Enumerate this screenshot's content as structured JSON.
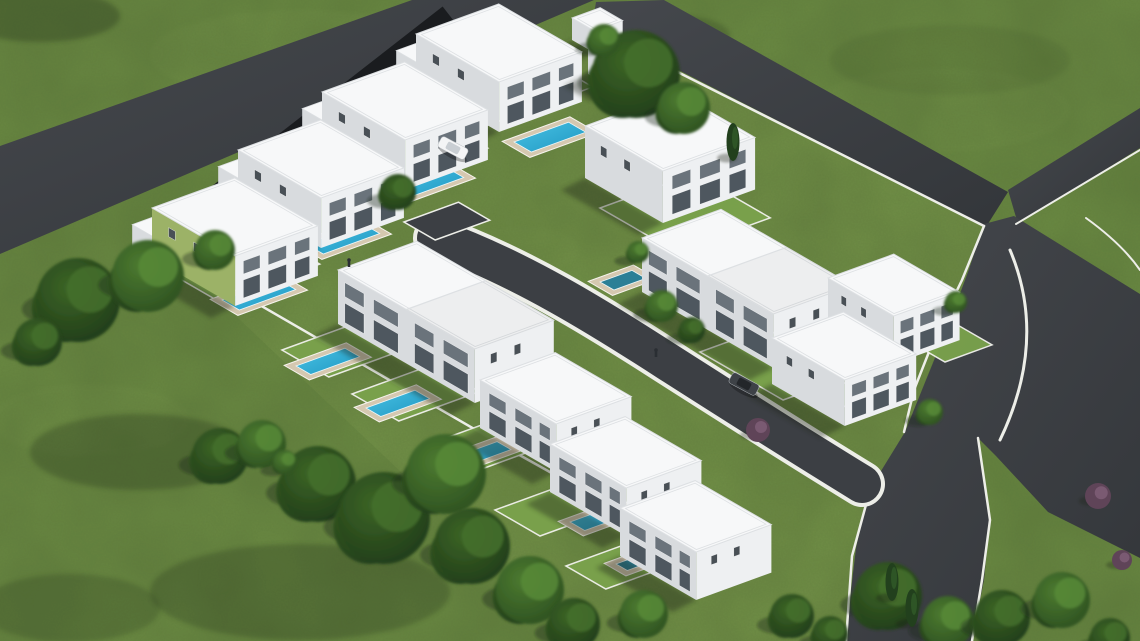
{
  "meta": {
    "description": "Aerial isometric 3D architectural rendering of a residential development: fourteen white flat-roof villas with private swimming pools and walled gardens on a green field, bounded by dark asphalt roads with an internal cul-de-sac street, scattered trees and shrubs",
    "canvas": {
      "width": 1140,
      "height": 641
    }
  },
  "palette": {
    "grass": "#6b8b43",
    "grass_tint": "#7b9a4e",
    "grass_light": "#8fae5f",
    "grass_dark": "#1e2c12",
    "road_a": "#45484d",
    "road_b": "#33363a",
    "road_internal": "#3c3f44",
    "lane": "#1a1c1f",
    "curb": "#edeee8",
    "garden": "#7aa24c",
    "garden_wall": "#f2f2ed",
    "roof": "#f7f8f9",
    "roof_edge": "#dde0e3",
    "wall_front": "#eef0f2",
    "wall_side": "#d8dbde",
    "accent_green": "#9cb267",
    "window_upper": "#6a737b",
    "window_lower": "#4e575f",
    "window_slit": "#495056",
    "pool_light": "#49c2e4",
    "pool_deep": "#1f97c2",
    "pool_teal": "#2b7f96",
    "deck": "#d5c8b0",
    "deck_edge": "#f6f4ee",
    "tree_dark_in": "#3c6526",
    "tree_dark_out": "#1f3a18",
    "tree_mid_in": "#4c7a30",
    "tree_mid_out": "#2c4f20",
    "shrub_purple": "#5f4458",
    "shadow": "#1c2414",
    "car_white_body": "#f4f5f6",
    "car_white_top": "#c9ced3",
    "car_dark_body": "#3e4247",
    "car_dark_top": "#23262a",
    "person": "#2a2e33",
    "cypress": "#22401d"
  },
  "roads": [
    {
      "name": "road-northwest",
      "points": "412,0 594,0 0,254 0,146"
    },
    {
      "name": "road-northeast",
      "points": "596,2 664,0 1008,192 986,227 592,26"
    },
    {
      "name": "road-north-branch",
      "points": "1008,190 1140,108 1140,148 1018,224"
    },
    {
      "name": "road-east-southeast",
      "points": "984,224 1014,216 1140,294 1140,558 1048,512 996,456 978,438 990,520 984,580 972,641 845,641 856,548 868,492 905,432 926,380 948,326 968,272"
    }
  ],
  "block_tint": "594,26 986,227 905,432 856,548 845,641 580,641 168,252",
  "rear_lane": {
    "path": "M450,16 L170,234",
    "width": 24
  },
  "internal_road": {
    "path": "M436,238 C520,268 600,318 668,362 C740,408 800,446 862,484",
    "curb_width": 46,
    "road_width": 38
  },
  "hammerhead": {
    "x": 404,
    "y": 222,
    "w": 58,
    "d": 36
  },
  "curbs": [
    {
      "name": "wall-northeast-boundary",
      "path": "M594,30 L984,226",
      "w": 2.5
    },
    {
      "name": "curb-east-inner",
      "path": "M984,226 L962,280 L936,334 L914,390 L904,432",
      "w": 2.5
    },
    {
      "name": "curb-southeast-left",
      "path": "M870,490 L852,556 L846,641",
      "w": 2.5
    },
    {
      "name": "curb-southeast-right",
      "path": "M978,438 L990,520 L982,580 L972,641",
      "w": 2.5
    },
    {
      "name": "curb-north-branch",
      "path": "M1016,224 L1140,150",
      "w": 2
    },
    {
      "name": "curb-east-corner-arc",
      "path": "M1010,250 Q1048,340 1000,440",
      "w": 3
    },
    {
      "name": "curb-northeast-corner-arc",
      "path": "M1086,218 Q1122,244 1140,270",
      "w": 2
    },
    {
      "name": "wall-southwest-boundary",
      "path": "M168,252 L514,452 L600,500",
      "w": 2.5
    }
  ],
  "gardens": [
    {
      "x": 168,
      "y": 272,
      "w": 108,
      "d": 58
    },
    {
      "x": 252,
      "y": 214,
      "w": 108,
      "d": 58
    },
    {
      "x": 336,
      "y": 156,
      "w": 108,
      "d": 58
    },
    {
      "x": 428,
      "y": 98,
      "w": 120,
      "d": 60
    },
    {
      "x": 600,
      "y": 208,
      "w": 100,
      "d": 88
    },
    {
      "x": 282,
      "y": 350,
      "w": 86,
      "d": 54
    },
    {
      "x": 352,
      "y": 394,
      "w": 86,
      "d": 54
    },
    {
      "x": 424,
      "y": 446,
      "w": 86,
      "d": 54
    },
    {
      "x": 495,
      "y": 510,
      "w": 86,
      "d": 52
    },
    {
      "x": 566,
      "y": 566,
      "w": 76,
      "d": 46
    },
    {
      "x": 700,
      "y": 352,
      "w": 70,
      "d": 96
    },
    {
      "x": 806,
      "y": 300,
      "w": 54,
      "d": 46
    },
    {
      "x": 820,
      "y": 392,
      "w": 60,
      "d": 40
    },
    {
      "x": 900,
      "y": 336,
      "w": 50,
      "d": 52
    }
  ],
  "houses": [
    {
      "id": "villa-1-green",
      "x": 152,
      "y": 208,
      "w": 88,
      "d": 96,
      "h": 50,
      "front": "se",
      "wing": true,
      "accent": "#9cb267"
    },
    {
      "id": "villa-2",
      "x": 238,
      "y": 150,
      "w": 88,
      "d": 96,
      "h": 50,
      "front": "se",
      "wing": true
    },
    {
      "id": "villa-3",
      "x": 322,
      "y": 92,
      "w": 88,
      "d": 96,
      "h": 50,
      "front": "se",
      "wing": true
    },
    {
      "id": "villa-4",
      "x": 416,
      "y": 34,
      "w": 88,
      "d": 96,
      "h": 50,
      "front": "se",
      "wing": true
    },
    {
      "id": "villa-5",
      "x": 585,
      "y": 126,
      "w": 98,
      "d": 90,
      "h": 52,
      "front": "se"
    },
    {
      "id": "villa-6-semi-detached",
      "x": 338,
      "y": 270,
      "w": 84,
      "d": 158,
      "h": 54,
      "front": "sw",
      "split": true
    },
    {
      "id": "villa-7",
      "x": 480,
      "y": 380,
      "w": 80,
      "d": 88,
      "h": 48,
      "front": "sw"
    },
    {
      "id": "villa-8",
      "x": 550,
      "y": 444,
      "w": 80,
      "d": 88,
      "h": 48,
      "front": "sw"
    },
    {
      "id": "villa-9",
      "x": 620,
      "y": 508,
      "w": 80,
      "d": 88,
      "h": 48,
      "front": "sw"
    },
    {
      "id": "villa-10-semi-detached",
      "x": 642,
      "y": 238,
      "w": 84,
      "d": 152,
      "h": 54,
      "front": "sw",
      "split": true
    },
    {
      "id": "villa-11",
      "x": 772,
      "y": 338,
      "w": 76,
      "d": 84,
      "h": 46,
      "front": "se"
    },
    {
      "id": "villa-12",
      "x": 828,
      "y": 278,
      "w": 70,
      "d": 76,
      "h": 48,
      "front": "se"
    },
    {
      "id": "utility-box-1",
      "x": 572,
      "y": 18,
      "w": 30,
      "d": 26,
      "h": 22,
      "plain": true
    },
    {
      "id": "utility-box-2",
      "x": 588,
      "y": 48,
      "w": 36,
      "d": 30,
      "h": 26,
      "plain": true
    }
  ],
  "pools": [
    {
      "x": 222,
      "y": 300,
      "len": 60,
      "wid": 20,
      "tone": "bright"
    },
    {
      "x": 306,
      "y": 244,
      "len": 60,
      "wid": 20,
      "tone": "bright"
    },
    {
      "x": 390,
      "y": 188,
      "len": 60,
      "wid": 20,
      "tone": "bright"
    },
    {
      "x": 514,
      "y": 142,
      "len": 58,
      "wid": 20,
      "tone": "bright"
    },
    {
      "x": 600,
      "y": 282,
      "len": 34,
      "wid": 16,
      "tone": "teal"
    },
    {
      "x": 296,
      "y": 366,
      "len": 52,
      "wid": 17,
      "tone": "bright"
    },
    {
      "x": 366,
      "y": 408,
      "len": 52,
      "wid": 17,
      "tone": "bright"
    },
    {
      "x": 452,
      "y": 458,
      "len": 48,
      "wid": 16,
      "tone": "bright"
    },
    {
      "x": 570,
      "y": 522,
      "len": 52,
      "wid": 17,
      "tone": "bright"
    },
    {
      "x": 616,
      "y": 564,
      "len": 26,
      "wid": 13,
      "tone": "teal"
    },
    {
      "x": 798,
      "y": 320,
      "len": 30,
      "wid": 14,
      "tone": "teal"
    }
  ],
  "cars": [
    {
      "id": "car-white",
      "x": 453,
      "y": 148,
      "body": "#f4f5f6",
      "top": "#c9ced3",
      "angle": 28
    },
    {
      "id": "car-dark",
      "x": 744,
      "y": 384,
      "body": "#3e4247",
      "top": "#23262a",
      "angle": 28
    }
  ],
  "people": [
    [
      349,
      260
    ],
    [
      656,
      350
    ]
  ],
  "trees": [
    [
      78,
      300,
      42,
      "d"
    ],
    [
      148,
      276,
      36,
      "m"
    ],
    [
      38,
      342,
      24,
      "d"
    ],
    [
      215,
      250,
      20,
      "m"
    ],
    [
      398,
      192,
      18,
      "d"
    ],
    [
      636,
      74,
      44,
      "d"
    ],
    [
      684,
      108,
      26,
      "m"
    ],
    [
      604,
      40,
      16,
      "m"
    ],
    [
      733,
      142,
      0,
      "c"
    ],
    [
      662,
      306,
      16,
      "m"
    ],
    [
      692,
      330,
      13,
      "d"
    ],
    [
      638,
      252,
      11,
      "m"
    ],
    [
      220,
      456,
      28,
      "d"
    ],
    [
      262,
      444,
      24,
      "m"
    ],
    [
      318,
      484,
      38,
      "d"
    ],
    [
      384,
      518,
      46,
      "d"
    ],
    [
      446,
      474,
      40,
      "m"
    ],
    [
      472,
      546,
      38,
      "d"
    ],
    [
      530,
      590,
      34,
      "m"
    ],
    [
      574,
      624,
      26,
      "d"
    ],
    [
      644,
      614,
      24,
      "m"
    ],
    [
      285,
      462,
      12,
      "m"
    ],
    [
      792,
      616,
      22,
      "d"
    ],
    [
      830,
      634,
      18,
      "d"
    ],
    [
      888,
      596,
      34,
      "d"
    ],
    [
      948,
      622,
      26,
      "m"
    ],
    [
      1002,
      618,
      28,
      "d"
    ],
    [
      1062,
      600,
      28,
      "m"
    ],
    [
      1110,
      638,
      20,
      "d"
    ],
    [
      892,
      582,
      0,
      "c"
    ],
    [
      912,
      608,
      0,
      "c"
    ],
    [
      1098,
      496,
      13,
      "p"
    ],
    [
      758,
      430,
      12,
      "p"
    ],
    [
      1122,
      560,
      10,
      "p"
    ],
    [
      930,
      412,
      13,
      "m"
    ],
    [
      956,
      302,
      11,
      "m"
    ]
  ],
  "shade_patches": [
    [
      40,
      16,
      80,
      26,
      0.3
    ],
    [
      140,
      452,
      110,
      38,
      0.26
    ],
    [
      300,
      592,
      150,
      48,
      0.24
    ],
    [
      70,
      608,
      90,
      34,
      0.2
    ],
    [
      950,
      60,
      120,
      35,
      0.08
    ],
    [
      250,
      110,
      100,
      30,
      0.08
    ],
    [
      1070,
      450,
      55,
      22,
      0.1
    ],
    [
      680,
      36,
      50,
      20,
      0.22
    ]
  ],
  "light_patches": [
    [
      300,
      55,
      150,
      45,
      0.12
    ],
    [
      940,
      110,
      130,
      42,
      0.1
    ],
    [
      1060,
      330,
      70,
      30,
      0.12
    ],
    [
      90,
      420,
      100,
      36,
      0.1
    ],
    [
      520,
      250,
      60,
      24,
      0.08
    ]
  ]
}
